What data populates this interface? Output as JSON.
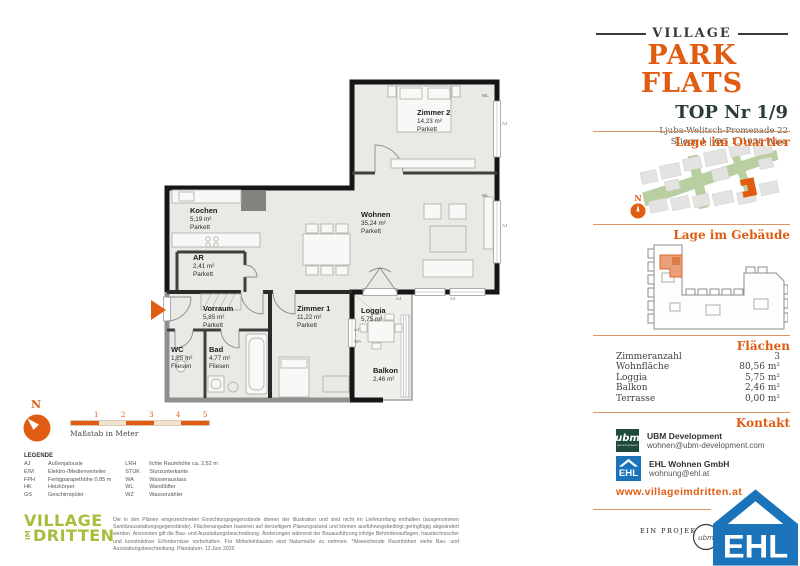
{
  "header": {
    "brand_top": "VILLAGE",
    "brand_main": "PARK FLATS",
    "unit_title": "TOP Nr 1/9",
    "address_line1": "Ljuba-Welitsch-Promenade 22",
    "address_line2": "Stiege 1 | OG 1, 1030 Wien"
  },
  "sidebar": {
    "quartier_title": "Lage im Quartier",
    "gebaeude_title": "Lage im Gebäude",
    "compass_label": "N",
    "flaechen": {
      "title": "Flächen",
      "rows": [
        {
          "label": "Zimmeranzahl",
          "value": "3"
        },
        {
          "label": "Wohnfläche",
          "value": "80,56 m²"
        },
        {
          "label": "Loggia",
          "value": "5,75 m²"
        },
        {
          "label": "Balkon",
          "value": "2,46 m²"
        },
        {
          "label": "Terrasse",
          "value": "0,00 m²"
        }
      ]
    },
    "kontakt": {
      "title": "Kontakt",
      "contacts": [
        {
          "name": "UBM Development",
          "email": "wohnen@ubm-development.com"
        },
        {
          "name": "EHL Wohnen GmbH",
          "email": "wohnung@ehl.at"
        }
      ],
      "website": "www.villageimdritten.at"
    }
  },
  "plan": {
    "rooms": [
      {
        "name": "Zimmer 2",
        "area": "14,23 m²",
        "floor": "Parkett"
      },
      {
        "name": "Wohnen",
        "area": "35,24 m²",
        "floor": "Parkett"
      },
      {
        "name": "Kochen",
        "area": "5,19 m²",
        "floor": "Parkett"
      },
      {
        "name": "AR",
        "area": "2,41 m²",
        "floor": "Parkett"
      },
      {
        "name": "Vorraum",
        "area": "5,85 m²",
        "floor": "Parkett"
      },
      {
        "name": "WC",
        "area": "1,85 m²",
        "floor": "Fliesen"
      },
      {
        "name": "Bad",
        "area": "4,77 m²",
        "floor": "Fliesen"
      },
      {
        "name": "Zimmer 1",
        "area": "11,22 m²",
        "floor": "Parkett"
      },
      {
        "name": "Loggia",
        "area": "5,75 m²"
      },
      {
        "name": "Balkon",
        "area": "2,46 m²"
      }
    ],
    "wall_labels": {
      "wl": "WL",
      "aj": "AJ",
      "wa": "WA"
    }
  },
  "footer": {
    "compass_label": "N",
    "scale": {
      "ticks": [
        "1",
        "2",
        "3",
        "4",
        "5"
      ],
      "caption": "Maßstab in Meter"
    },
    "legend": {
      "title": "LEGENDE",
      "col1": [
        {
          "code": "AJ",
          "text": "Außenjalousie"
        },
        {
          "code": "E/M",
          "text": "Elektro-/Medienverteiler"
        },
        {
          "code": "FPH",
          "text": "Fertigparapethöhe 0,85 m"
        },
        {
          "code": "HK",
          "text": "Heizkörper"
        },
        {
          "code": "GS",
          "text": "Geschirrspüler"
        }
      ],
      "col2": [
        {
          "code": "LRH",
          "text": "lichte Raumhöhe ca. 2,52 m"
        },
        {
          "code": "STUK",
          "text": "Sturzunterkante"
        },
        {
          "code": "WA",
          "text": "Wasserauslass"
        },
        {
          "code": "WL",
          "text": "Wandlüfter"
        },
        {
          "code": "WZ",
          "text": "Wasserzähler"
        }
      ]
    },
    "village_logo": {
      "line1": "VILLAGE",
      "im": "IM",
      "line2": "DRITTEN"
    },
    "disclaimer": "Die in den Plänen eingezeichneten Einrichtungsgegenstände dienen der Illustration und sind nicht im Lieferumfang enthalten (ausgenommen Sanitärausstattungsgegenstände). Flächenangaben basieren auf derzeitigem Planungsstand und können ausführungsbedingt geringfügig abgeändert werden. Ansonsten gilt die Bau- und Ausstattungsbeschreibung. Änderungen während der Bauausführung infolge Behördenauflagen, haustechnischer und konstruktiver Erfordernisse vorbehalten. Für Möbeleinbauten sind Naturmaße zu nehmen. *Abweichende Raumhöhen siehe Bau- und Ausstattungsbeschreibung. Plandatum: 12.Juni 2025",
    "project_by": "EIN PROJEKT VON",
    "ubm_logo_text": "ubm",
    "ubm_logo_sub": "development",
    "ehl_logo_text": "EHL"
  }
}
